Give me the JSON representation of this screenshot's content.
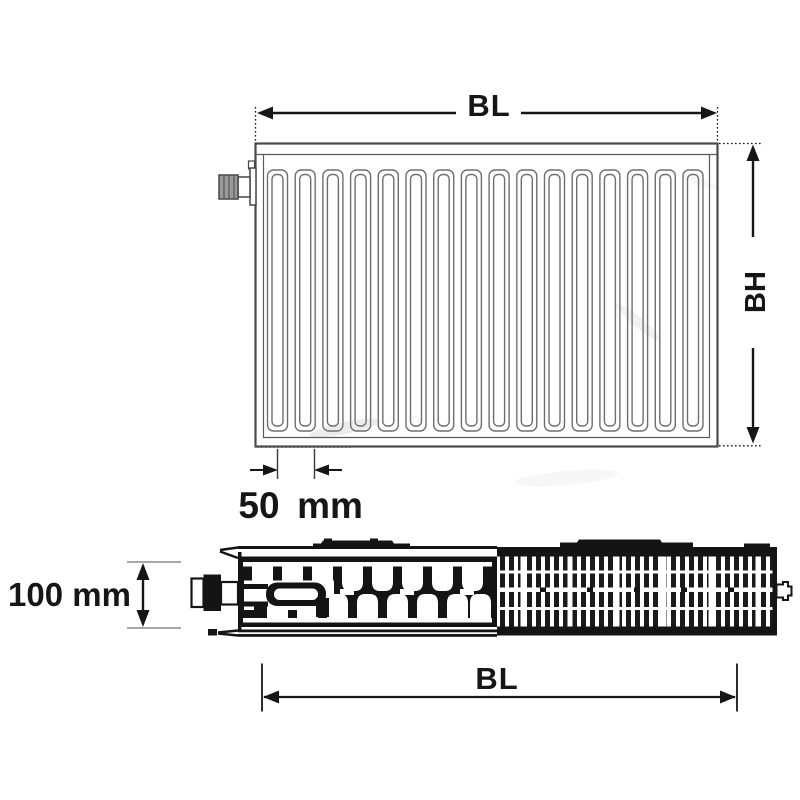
{
  "drawing": {
    "front_view": {
      "width_label": "BL",
      "height_label": "BH",
      "spacing_value": "50",
      "spacing_unit": "mm"
    },
    "top_view": {
      "depth_label": "100 mm",
      "width_label": "BL"
    }
  },
  "colors": {
    "background": "#ffffff",
    "dimension": "#161616",
    "outline": "#4a4a4a",
    "channel_line": "#6e6e6e",
    "dark_fill": "#141414"
  }
}
